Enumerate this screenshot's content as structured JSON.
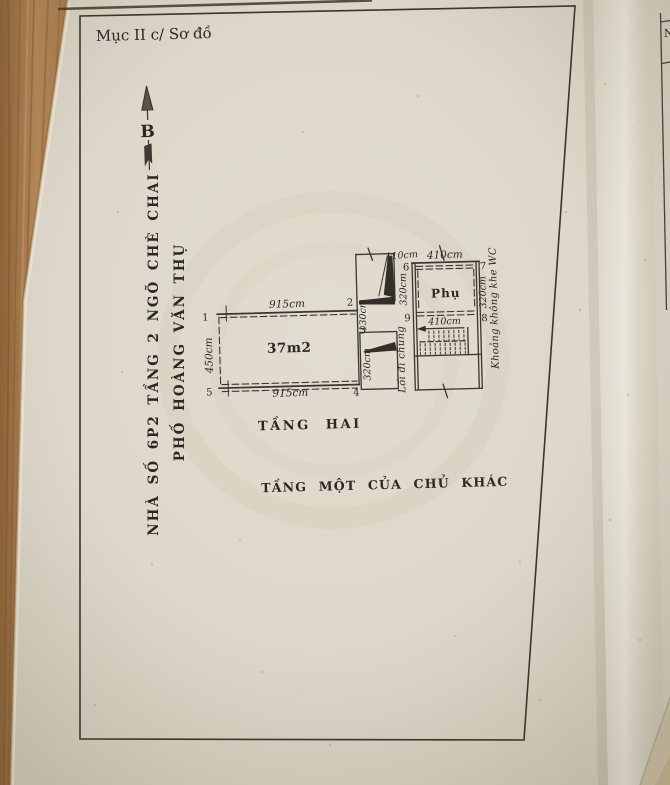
{
  "colors": {
    "paper": "#ddd8ca",
    "wood": "#a87d4c",
    "ink": "#2b2723",
    "line": "#3a352e",
    "under_sheet": "#cdc2a8"
  },
  "header": {
    "label": "Mục II c/ Sơ đồ"
  },
  "compass": {
    "label": "B"
  },
  "side_title": {
    "line1": "NHÀ SỐ 6P2 TẦNG 2 NGÕ CHÈ CHAI",
    "line2": "PHỐ HOÀNG VĂN THỤ"
  },
  "plan": {
    "main_room": {
      "area_label": "37m2",
      "dim_top": "915cm",
      "dim_bottom": "915cm",
      "dim_left": "450cm"
    },
    "dim_2_3": "130cm",
    "door_bay": {
      "dim": "320cm"
    },
    "corridor": {
      "label": "Lối đi chung",
      "dim_width": "110cm",
      "dim_length": "320cm"
    },
    "aux_room": {
      "label": "Phụ",
      "dim_top": "410cm",
      "dim_right": "320cm"
    },
    "stairs": {
      "dim": "410cm"
    },
    "side_note": "Khoảng không khe WC",
    "markers": {
      "m1": "1",
      "m2": "2",
      "m3": "3",
      "m4": "4",
      "m5": "5",
      "m6": "6",
      "m7": "7",
      "m8": "8",
      "m9": "9"
    }
  },
  "captions": {
    "floor_two": "TẦNG HAI",
    "floor_one": "TẦNG MỘT CỦA CHỦ KHÁC"
  },
  "adjacent_page": {
    "fragment": "N"
  }
}
